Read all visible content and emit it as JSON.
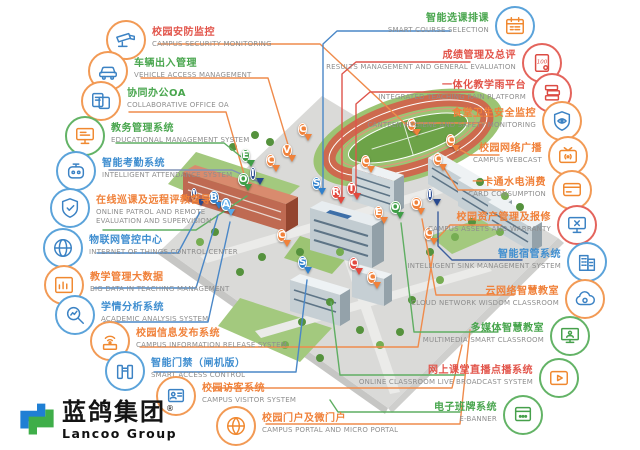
{
  "page": {
    "background": "#ffffff"
  },
  "brand": {
    "logo_cn": "蓝鸽集团",
    "logo_en": "Lancoo Group",
    "registered_mark": "®"
  },
  "palette": {
    "orange": "#f0813a",
    "red": "#e2493f",
    "green": "#3f9e47",
    "blue": "#2f80cc",
    "lightblue": "#5aa9e6",
    "navy": "#27488e"
  },
  "left_features": [
    {
      "title": "校园安防监控",
      "subtitle": "CAMPUS SECURITY MONITORING",
      "icon": "security-camera-icon",
      "accent": "orange"
    },
    {
      "title": "车辆出入管理",
      "subtitle": "VEHICLE ACCESS MANAGEMENT",
      "icon": "car-icon",
      "accent": "orange"
    },
    {
      "title": "协同办公OA",
      "subtitle": "COLLABORATIVE OFFICE OA",
      "icon": "oa-document-icon",
      "accent": "orange"
    },
    {
      "title": "教务管理系统",
      "subtitle": "EDUCATIONAL MANAGEMENT SYSTEM",
      "icon": "monitor-icon",
      "accent": "green"
    },
    {
      "title": "智能考勤系统",
      "subtitle": "INTELLIGENT ATTENDANCE SYSTEM",
      "icon": "robot-icon",
      "accent": "blue"
    },
    {
      "title": "在线巡课及远程评教督导",
      "subtitle": "ONLINE PATROL AND REMOTE EVALUATION AND SUPERVISION",
      "icon": "shield-icon",
      "accent": "blue"
    },
    {
      "title": "物联网管控中心",
      "subtitle": "INTERNET OF THINGS CONTROL CENTER",
      "icon": "globe-icon",
      "accent": "blue"
    },
    {
      "title": "教学管理大数据",
      "subtitle": "BIG DATA IN TEACHING MANAGEMENT",
      "icon": "bar-chart-icon",
      "accent": "orange"
    },
    {
      "title": "学情分析系统",
      "subtitle": "ACADEMIC ANALYSIS SYSTEM",
      "icon": "magnifier-chart-icon",
      "accent": "blue"
    },
    {
      "title": "校园信息发布系统",
      "subtitle": "CAMPUS INFORMATION RELEASE SYSTEM",
      "icon": "wifi-broadcast-icon",
      "accent": "orange"
    },
    {
      "title": "智能门禁（闸机版）",
      "subtitle": "SMART ACCESS CONTROL",
      "icon": "gate-icon",
      "accent": "blue"
    },
    {
      "title": "校园访客系统",
      "subtitle": "CAMPUS VISITOR SYSTEM",
      "icon": "visitor-badge-icon",
      "accent": "orange"
    },
    {
      "title": "校园门户及微门户",
      "subtitle": "CAMPUS PORTAL AND MICRO PORTAL",
      "icon": "portal-globe-icon",
      "accent": "orange"
    }
  ],
  "right_features": [
    {
      "title": "智能选课排课",
      "subtitle": "SMART COURSE SELECTION",
      "icon": "calendar-icon",
      "accent": "blue"
    },
    {
      "title": "成绩管理及总评",
      "subtitle": "RESULTS MANAGEMENT AND GENERAL EVALUATION",
      "icon": "score-100-icon",
      "accent": "red"
    },
    {
      "title": "一体化教学雨平台",
      "subtitle": "INTEGRATED TEACHING RAIN PLATFORM",
      "icon": "books-icon",
      "accent": "red"
    },
    {
      "title": "食堂卫生安全监控",
      "subtitle": "CANTEEN HYGIENE AND SAFETY MONITORING",
      "icon": "shield-eye-icon",
      "accent": "orange"
    },
    {
      "title": "校园网络广播",
      "subtitle": "CAMPUS WEBCAST",
      "icon": "tv-broadcast-icon",
      "accent": "orange"
    },
    {
      "title": "一卡通水电消费",
      "subtitle": "CARD CONSUMPTION",
      "icon": "card-icon",
      "accent": "orange"
    },
    {
      "title": "校园资产管理及报修",
      "subtitle": "CAMPUS ASSETS AND WARRANTY",
      "icon": "pc-tools-icon",
      "accent": "red"
    },
    {
      "title": "智能宿管系统",
      "subtitle": "INTELLIGENT SINK MANAGEMENT SYSTEM",
      "icon": "building-icon",
      "accent": "blue"
    },
    {
      "title": "云网络智慧教室",
      "subtitle": "CLOUD NETWORK WISDOM CLASSROOM",
      "icon": "cloud-icon",
      "accent": "orange"
    },
    {
      "title": "多媒体智慧教室",
      "subtitle": "MULTIMEDIA SMART CLASSROOM",
      "icon": "smart-screen-icon",
      "accent": "green"
    },
    {
      "title": "网上课堂直播点播系统",
      "subtitle": "ONLINE CLASSROOM LIVE BROADCAST SYSTEM",
      "icon": "video-play-icon",
      "accent": "green"
    },
    {
      "title": "电子班牌系统",
      "subtitle": "E-BANNER",
      "icon": "e-banner-icon",
      "accent": "green"
    }
  ],
  "campus": {
    "pins": [
      {
        "letter": "C",
        "color": "orange",
        "x": 308,
        "y": 142
      },
      {
        "letter": "V",
        "color": "orange",
        "x": 292,
        "y": 163
      },
      {
        "letter": "E",
        "color": "green",
        "x": 251,
        "y": 168
      },
      {
        "letter": "C",
        "color": "orange",
        "x": 276,
        "y": 173
      },
      {
        "letter": "I",
        "color": "navy",
        "x": 260,
        "y": 186
      },
      {
        "letter": "O",
        "color": "green",
        "x": 248,
        "y": 192
      },
      {
        "letter": "I",
        "color": "navy",
        "x": 201,
        "y": 207
      },
      {
        "letter": "B",
        "color": "blue",
        "x": 219,
        "y": 210
      },
      {
        "letter": "A",
        "color": "lightblue",
        "x": 231,
        "y": 217
      },
      {
        "letter": "S",
        "color": "blue",
        "x": 322,
        "y": 196
      },
      {
        "letter": "R",
        "color": "red",
        "x": 341,
        "y": 205
      },
      {
        "letter": "T",
        "color": "red",
        "x": 357,
        "y": 201
      },
      {
        "letter": "C",
        "color": "orange",
        "x": 417,
        "y": 137
      },
      {
        "letter": "C",
        "color": "orange",
        "x": 371,
        "y": 174
      },
      {
        "letter": "C",
        "color": "orange",
        "x": 456,
        "y": 153
      },
      {
        "letter": "C",
        "color": "orange",
        "x": 443,
        "y": 172
      },
      {
        "letter": "I",
        "color": "navy",
        "x": 437,
        "y": 207
      },
      {
        "letter": "O",
        "color": "orange",
        "x": 421,
        "y": 216
      },
      {
        "letter": "O",
        "color": "green",
        "x": 400,
        "y": 220
      },
      {
        "letter": "E",
        "color": "orange",
        "x": 384,
        "y": 225
      },
      {
        "letter": "C",
        "color": "orange",
        "x": 434,
        "y": 246
      },
      {
        "letter": "C",
        "color": "orange",
        "x": 287,
        "y": 248
      },
      {
        "letter": "S",
        "color": "blue",
        "x": 308,
        "y": 275
      },
      {
        "letter": "C",
        "color": "red",
        "x": 359,
        "y": 276
      },
      {
        "letter": "C",
        "color": "orange",
        "x": 377,
        "y": 290
      }
    ]
  }
}
